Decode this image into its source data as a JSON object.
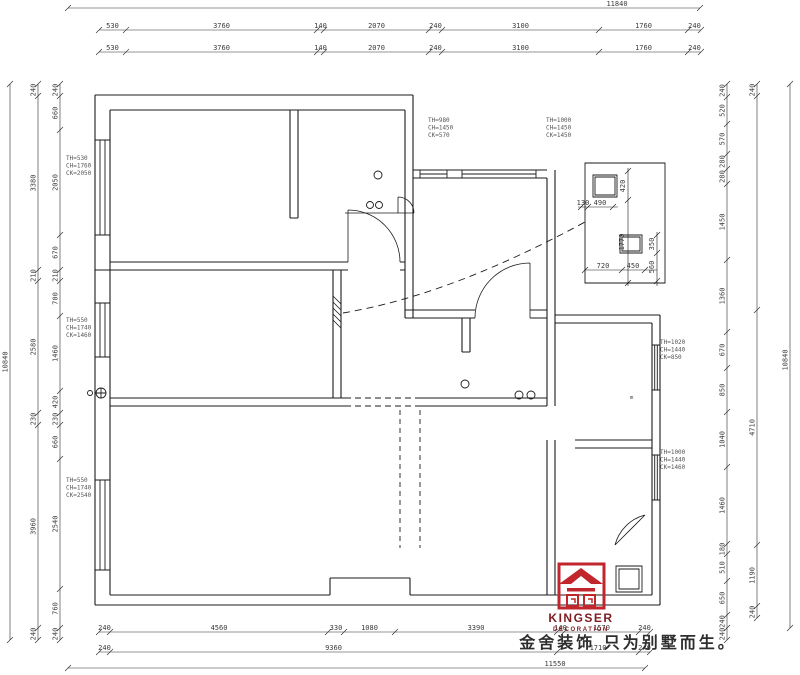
{
  "line_color": "#1b1b1b",
  "dim_color": "#3a3a3a",
  "logo": {
    "brand": "KINGSER",
    "sub": "DECORATION",
    "tagline": "金舍装饰 只为别墅而生。",
    "brand_color": "#7d2024",
    "emblem_color": "#c1262c"
  },
  "dim_top": {
    "total": "11840",
    "row2": [
      "530",
      "3760",
      "140",
      "2070",
      "240",
      "3100",
      "1760",
      "240"
    ],
    "row3": [
      "530",
      "3760",
      "140",
      "2070",
      "240",
      "3100",
      "1760",
      "240"
    ]
  },
  "dim_bottom": {
    "row1": [
      "240",
      "4560",
      "330",
      "1080",
      "3390",
      "140",
      "1570",
      "240"
    ],
    "row2": [
      "240",
      "9360",
      "1710",
      "240"
    ],
    "total": "11550"
  },
  "dim_left": {
    "total": "10840",
    "outer": [
      "240",
      "3380",
      "210",
      "2580",
      "230",
      "3960",
      "240"
    ],
    "inner": [
      "240",
      "660",
      "2050",
      "670",
      "210",
      "700",
      "1460",
      "420",
      "230",
      "660",
      "2540",
      "760",
      "240"
    ]
  },
  "dim_right": {
    "total": "10840",
    "inner": [
      "240",
      "520",
      "570",
      "280",
      "280",
      "1450",
      "1360",
      "670",
      "850",
      "1040",
      "1460",
      "180",
      "510",
      "650",
      "240",
      "240"
    ],
    "outer": [
      "240",
      "4710",
      "1190",
      "240"
    ]
  },
  "detail_dims": [
    "130",
    "490",
    "420",
    "1770",
    "350",
    "560",
    "720",
    "450"
  ],
  "window_tags": [
    [
      "TH=530",
      "CH=1760",
      "CK=2050"
    ],
    [
      "TH=550",
      "CH=1740",
      "CK=1460"
    ],
    [
      "TH=550",
      "CH=1740",
      "CK=2540"
    ],
    [
      "TH=980",
      "CH=1450",
      "CK=570"
    ],
    [
      "TH=1000",
      "CH=1450",
      "CK=1450"
    ],
    [
      "TH=1020",
      "CH=1440",
      "CK=850"
    ],
    [
      "TH=1000",
      "CH=1440",
      "CK=1460"
    ]
  ],
  "misc": {
    "room_label": "m"
  }
}
